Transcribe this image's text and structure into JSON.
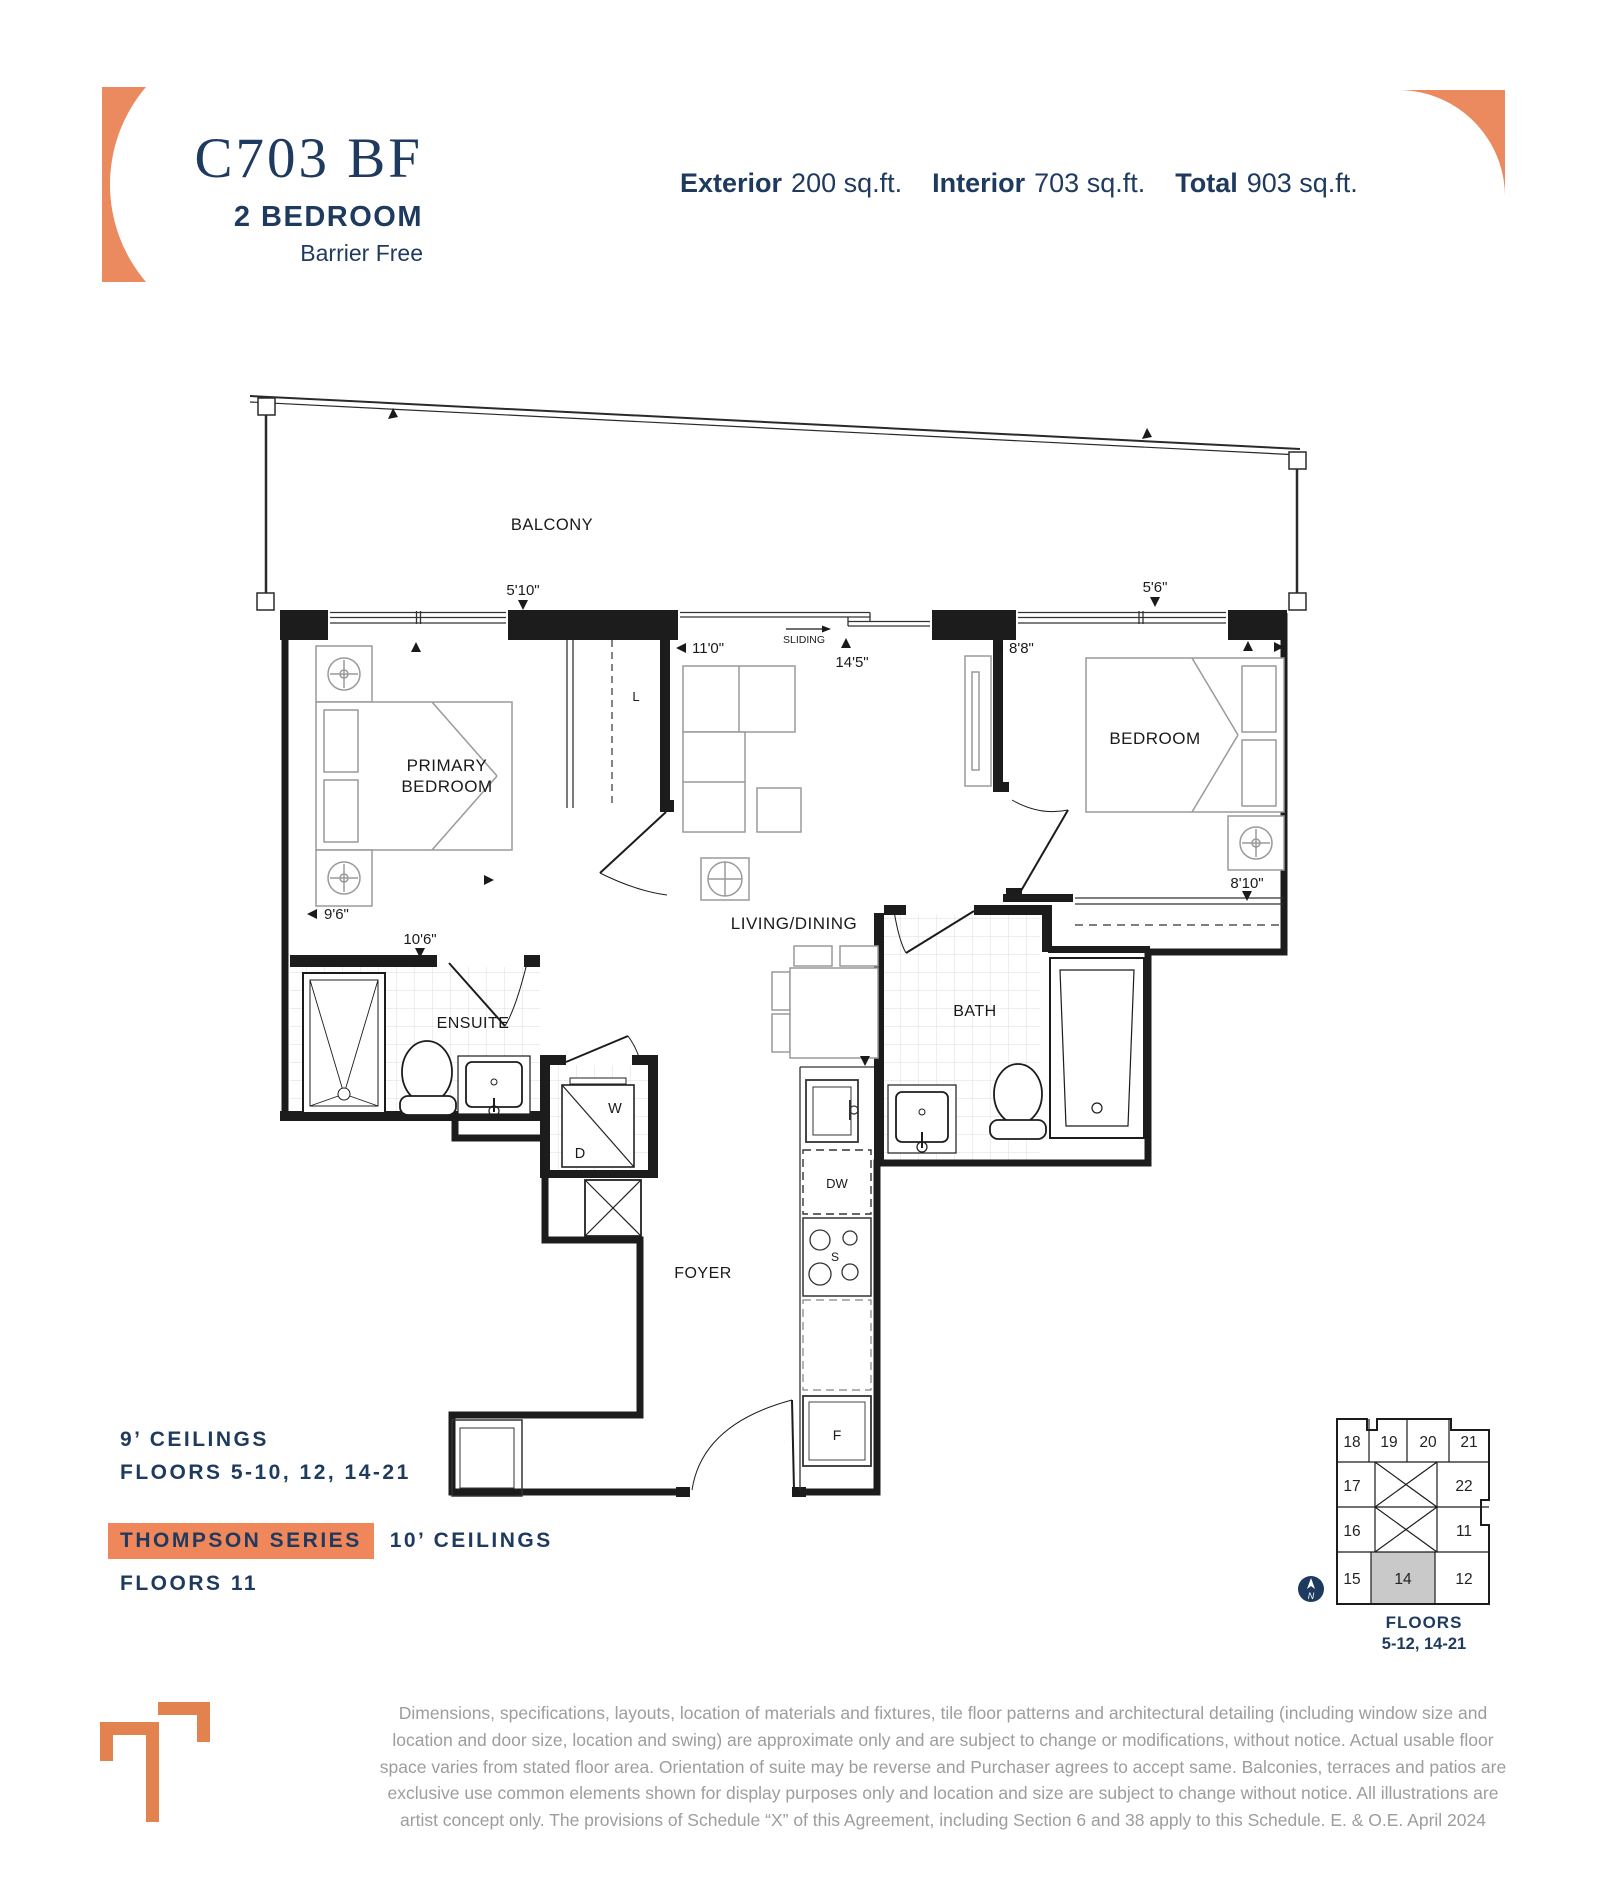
{
  "header": {
    "unit_code": "C703 BF",
    "unit_type": "2 BEDROOM",
    "unit_subtype": "Barrier Free",
    "areas": [
      {
        "label": "Exterior",
        "value": "200 sq.ft."
      },
      {
        "label": "Interior",
        "value": "703 sq.ft."
      },
      {
        "label": "Total",
        "value": "903 sq.ft."
      }
    ]
  },
  "plan": {
    "labels": {
      "balcony": "BALCONY",
      "primary_bedroom_line1": "PRIMARY",
      "primary_bedroom_line2": "BEDROOM",
      "living_dining": "LIVING/DINING",
      "bedroom": "BEDROOM",
      "ensuite": "ENSUITE",
      "bath": "BATH",
      "foyer": "FOYER",
      "sliding": "SLIDING"
    },
    "fixtures": {
      "washer": "W",
      "dryer": "D",
      "linen": "L",
      "dishwasher": "DW",
      "stove": "S",
      "fridge": "F"
    },
    "dimensions": {
      "d1": "5'10\"",
      "d2": "11'0\"",
      "d3": "14'5\"",
      "d4": "8'8\"",
      "d5": "5'6\"",
      "d6": "9'6\"",
      "d7": "10'6\"",
      "d8": "8'10\""
    }
  },
  "info": {
    "ceiling_9": "9’ CEILINGS",
    "floors_9": "FLOORS 5-10, 12, 14-21",
    "series_badge": "THOMPSON SERIES",
    "ceiling_10": "10’ CEILINGS",
    "floors_10": "FLOORS 11"
  },
  "keyplan": {
    "units": {
      "u18": "18",
      "u19": "19",
      "u20": "20",
      "u21": "21",
      "u17": "17",
      "u22": "22",
      "u16": "16",
      "u11": "11",
      "u15": "15",
      "u14": "14",
      "u12": "12"
    },
    "highlighted_unit": "14",
    "floors_label": "FLOORS",
    "floors_range": "5-12, 14-21",
    "compass": "N"
  },
  "disclaimer": "Dimensions, specifications, layouts, location of materials and fixtures, tile floor patterns and architectural detailing (including window size and location and door size, location and swing) are approximate only and are subject to change or modifications, without notice. Actual usable floor space varies from stated floor area. Orientation of suite may be reverse and Purchaser agrees to accept same. Balconies, terraces and patios are exclusive use common elements shown for display purposes only and location and size are subject to change without notice. All illustrations are artist concept only. The provisions of Schedule “X” of this Agreement, including Section 6 and 38 apply to this Schedule. E. & O.E. April 2024",
  "colors": {
    "navy": "#1E3A5E",
    "orange": "#EB8A5E",
    "orange_badge": "#F0875A",
    "plan_line": "#1C1C1C",
    "furniture_gray": "#9A9A9A",
    "tile_gray": "#DCDCDC",
    "disclaimer_gray": "#9D9D9D",
    "keyplan_highlight": "#C9C9C9"
  }
}
